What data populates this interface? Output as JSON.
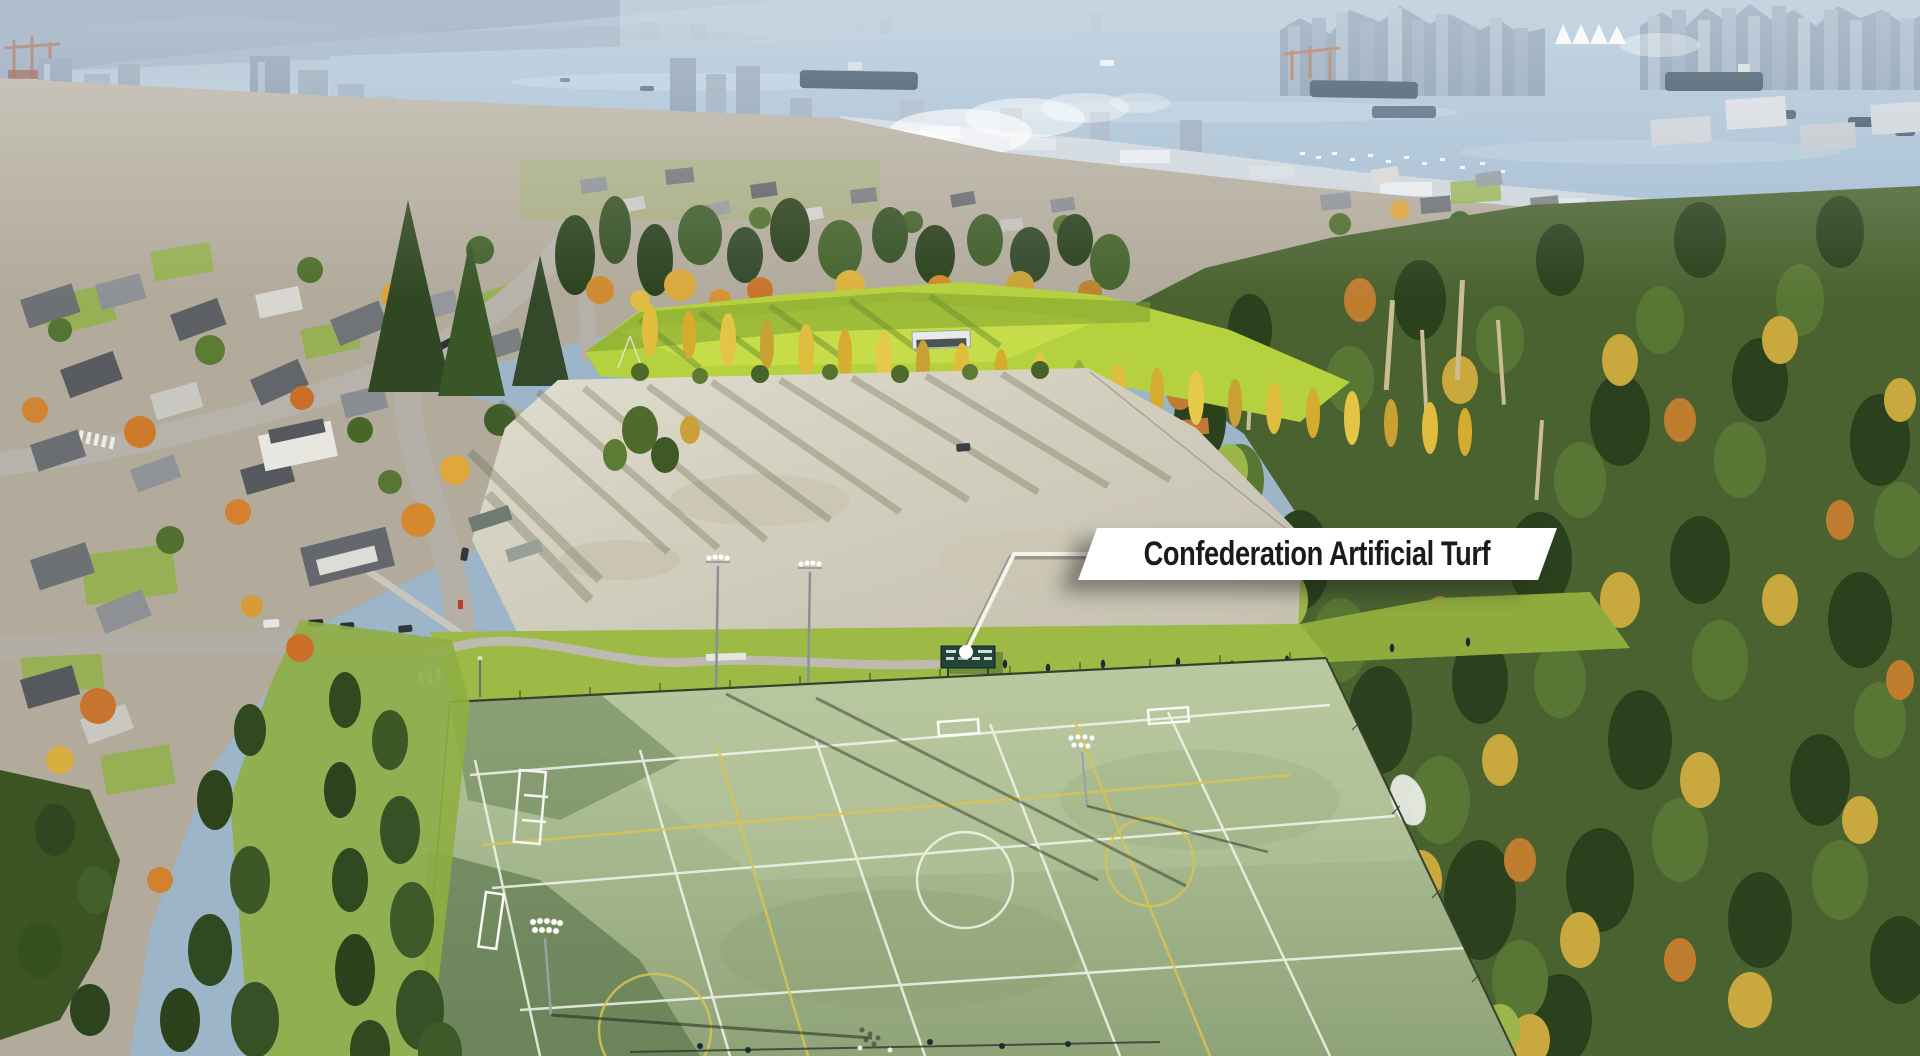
{
  "overlay": {
    "label_text": "Confederation Artificial Turf"
  },
  "palette": {
    "sky_haze": "#a9c0d4",
    "mountain": "#7e95ac",
    "water": "#a3bdd2",
    "city_silhouette": "#8ea5bb",
    "waterfront": "#ccd5dc",
    "ship_hull": "#2e4456",
    "residential": "#b2ab9c",
    "road": "#b5b1a8",
    "tree_green_dark": "#2b421e",
    "tree_green": "#557432",
    "autumn_yellow": "#d9a93c",
    "autumn_orange": "#cd7b2a",
    "grass_field": "#b5d13e",
    "poplar_yellow": "#e0bd3c",
    "gravel": "#d7d2c1",
    "grass_strip": "#9cba45",
    "turf": "#a8bc8d",
    "turf_shadow": "#5e7a4e",
    "forest": "#4a6230",
    "line_white": "#f3f5ec",
    "line_yellow": "#d9c355",
    "scoreboard": "#23443a",
    "banner_bg": "#ffffff",
    "banner_text": "#1b1b1b"
  }
}
